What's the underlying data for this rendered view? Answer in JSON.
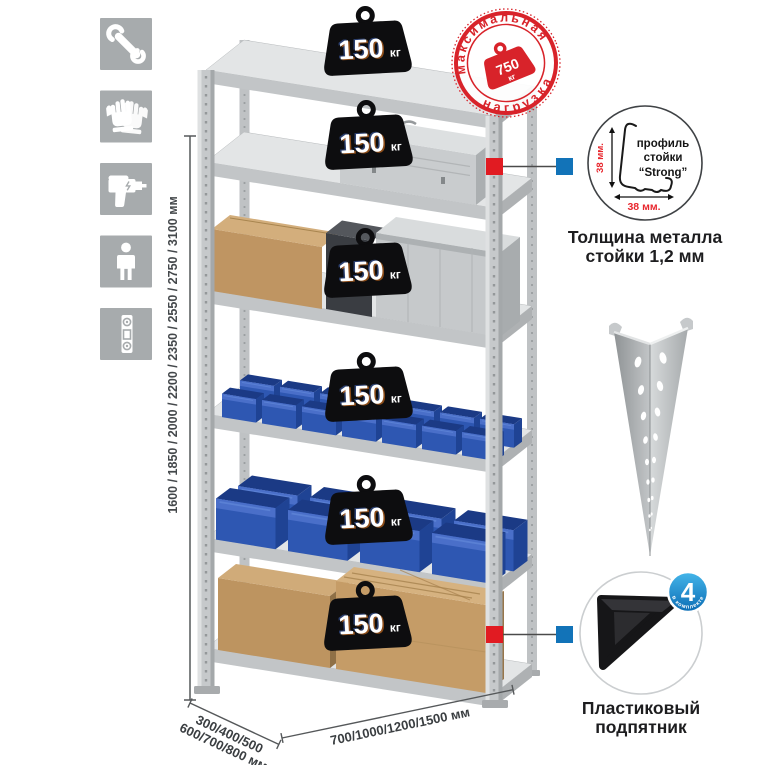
{
  "page": {
    "background": "#ffffff"
  },
  "colors": {
    "stamp_red": "#d8232a",
    "connector_red": "#e11b22",
    "connector_blue": "#1273b8",
    "accent_red": "#e8262d",
    "bin_blue": "#2e57b2",
    "icon_gray": "#a7abad",
    "metal_gray": "#c6c9cb",
    "cardboard": "#bd9460",
    "badge_black": "#0d0d0f",
    "count_badge_blue": "#1790d2"
  },
  "sidebar": {
    "icons": [
      {
        "name": "wrench-icon"
      },
      {
        "name": "gloves-icon"
      },
      {
        "name": "drill-icon"
      },
      {
        "name": "person-icon"
      },
      {
        "name": "level-icon"
      }
    ]
  },
  "dimensions": {
    "height": "1600 / 1850 / 2000 / 2200 / 2350 / 2550 / 2750 / 3100 мм",
    "depth_line1": "300/400/500",
    "depth_line2": "600/700/800 мм",
    "width": "700/1000/1200/1500 мм"
  },
  "shelf_badges": [
    {
      "value": "150",
      "unit": "кг"
    },
    {
      "value": "150",
      "unit": "кг"
    },
    {
      "value": "150",
      "unit": "кг"
    },
    {
      "value": "150",
      "unit": "кг"
    },
    {
      "value": "150",
      "unit": "кг"
    },
    {
      "value": "150",
      "unit": "кг"
    }
  ],
  "max_load_stamp": {
    "top_text": "максимальная",
    "bottom_text": "нагрузка",
    "value": "750",
    "unit": "кг"
  },
  "profile_detail": {
    "label_line1": "профиль",
    "label_line2": "стойки",
    "label_line3": "“Strong”",
    "dim_vertical": "38 мм.",
    "dim_horizontal": "38 мм.",
    "caption_line1": "Толщина металла",
    "caption_line2": "стойки 1,2 мм"
  },
  "foot_detail": {
    "count": "4",
    "ring_text": "в комплекте",
    "caption_line1": "Пластиковый",
    "caption_line2": "подпятник"
  }
}
